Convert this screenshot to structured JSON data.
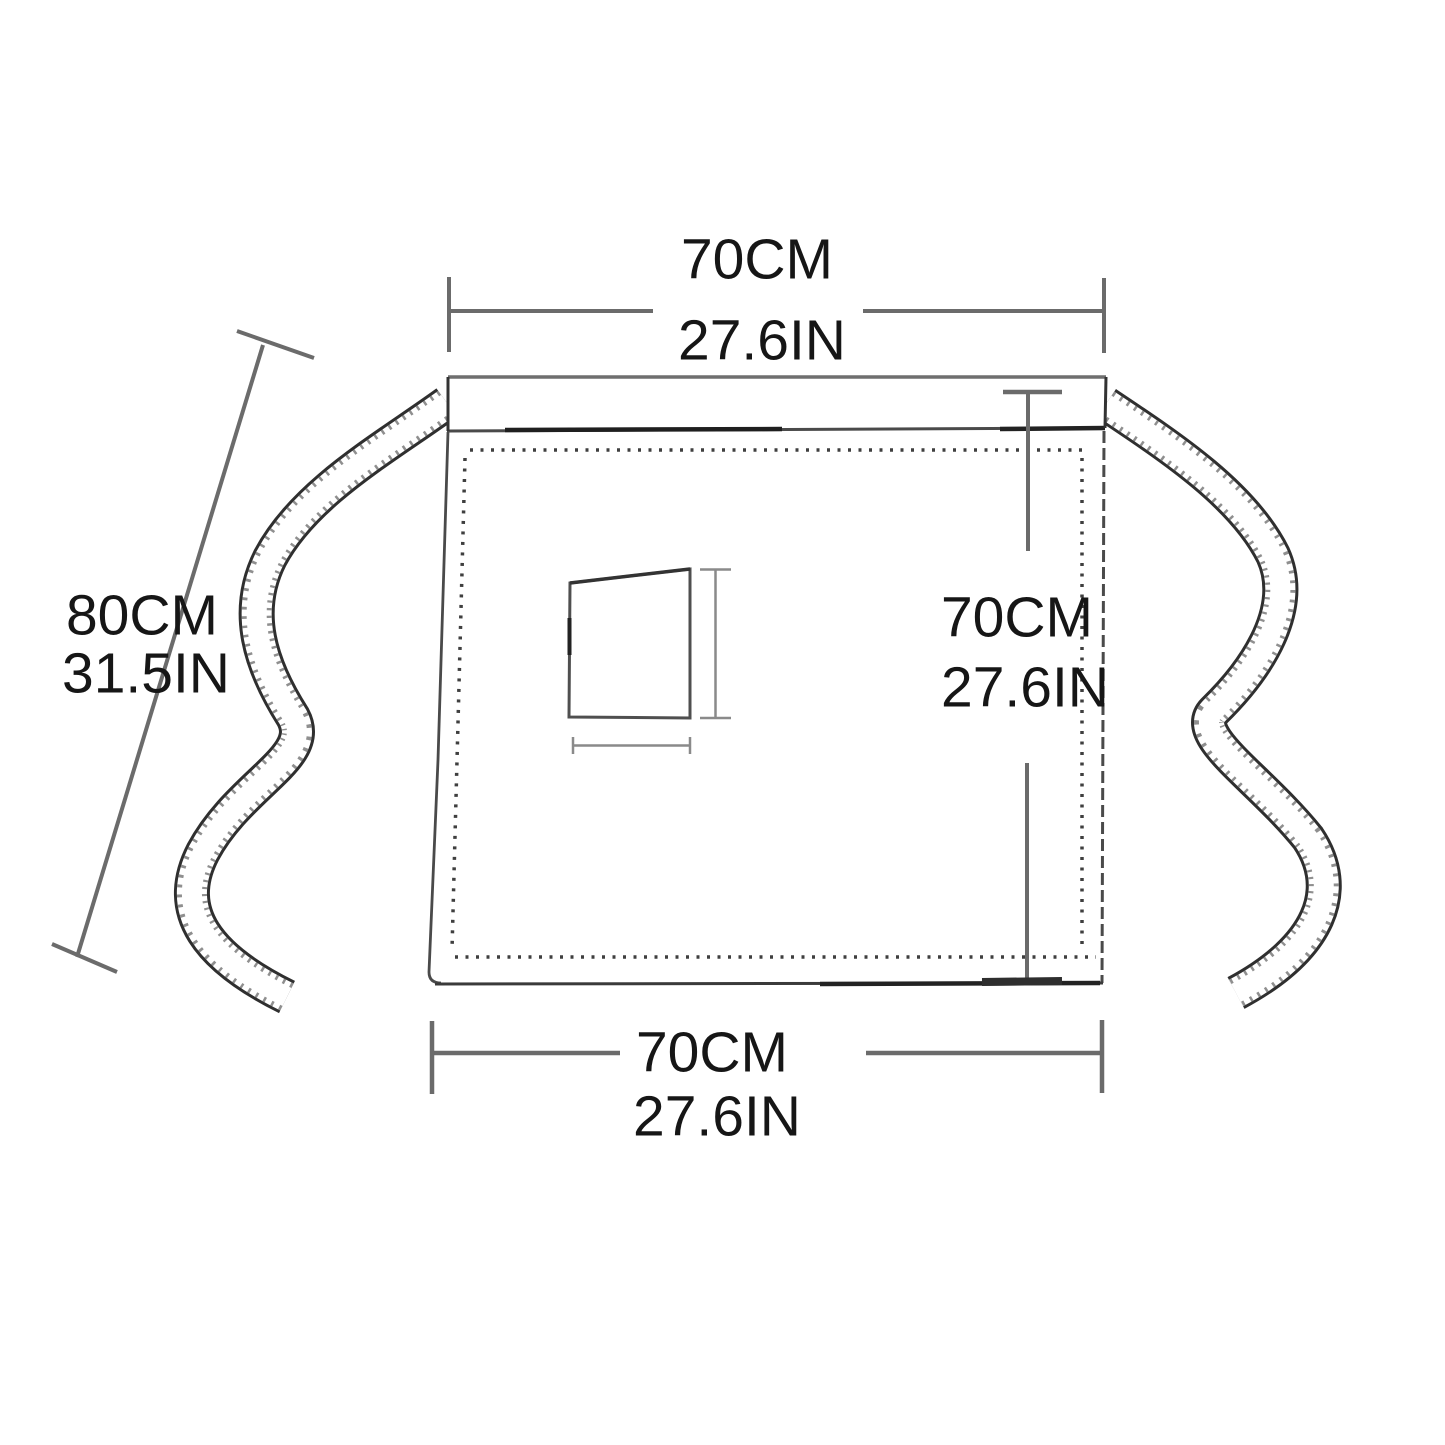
{
  "diagram": {
    "subject": "half waist apron with tie straps and front pocket - size diagram",
    "labels": {
      "top_width": {
        "cm": "70CM",
        "inch": "27.6IN"
      },
      "strap_length": {
        "cm": "80CM",
        "inch": "31.5IN"
      },
      "side_height": {
        "cm": "70CM",
        "inch": "27.6IN"
      },
      "bottom_width": {
        "cm": "70CM",
        "inch": "27.6IN"
      }
    },
    "colors": {
      "background": "#ffffff",
      "dimension_line": "#6b6b6b",
      "apron_outline": "#333333",
      "stitch_dots": "#3f3f3f",
      "text": "#161616"
    }
  }
}
